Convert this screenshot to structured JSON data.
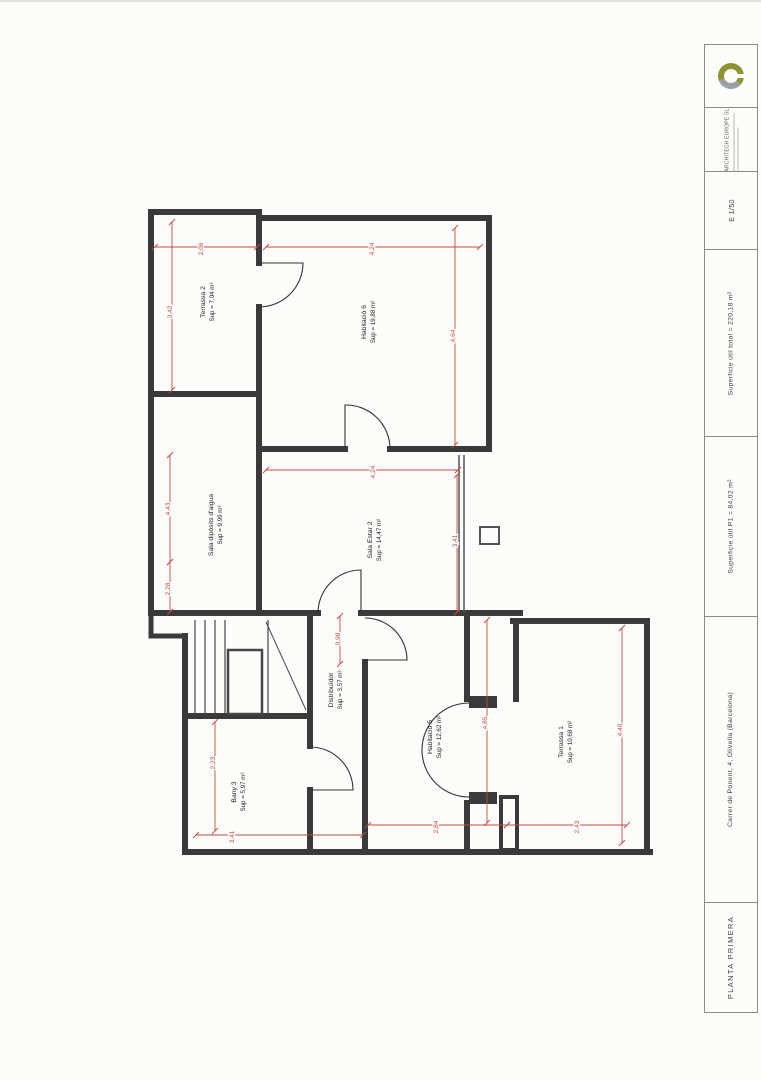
{
  "title_block": {
    "company": "ARCHITECH EUROPE SL",
    "scale": "E  1/50",
    "total_area": "Superficie útil total = 220,18 m²",
    "p1_area": "Superficie útil P1 = 84,02 m²",
    "address": "Carrer de Ponent, 4, Olivella (Barcelona)",
    "plan_name": "PLANTA PRIMERA"
  },
  "colors": {
    "dimension": "#c14a44",
    "wall": "#3a3a3a",
    "text": "#222222",
    "logo_olive": "#8f9433",
    "logo_gray": "#9aa0a6"
  },
  "drawing": {
    "rooms": [
      {
        "id": "terrassa-2",
        "name": "Terrassa 2",
        "area": "Sup = 7,04 m²",
        "x": 205,
        "y": 302
      },
      {
        "id": "habitacio-6",
        "name": "Habitació 6",
        "area": "Sup = 19,88 m²",
        "x": 366,
        "y": 322
      },
      {
        "id": "sala-diposits",
        "name": "Sala dipòsits d'aigua",
        "area": "Sup = 9,99 m²",
        "x": 213,
        "y": 525
      },
      {
        "id": "sala-estar-2",
        "name": "Sala Estar 2",
        "area": "Sup = 14,47 m²",
        "x": 372,
        "y": 540
      },
      {
        "id": "distribuidor",
        "name": "Distribuïdor",
        "area": "Sup = 3,57 m²",
        "x": 333,
        "y": 690
      },
      {
        "id": "habitacio-5",
        "name": "Habitació 5",
        "area": "Sup = 12,62 m²",
        "x": 432,
        "y": 737
      },
      {
        "id": "bany-3",
        "name": "Bany 3",
        "area": "Sup = 5,97 m²",
        "x": 236,
        "y": 792
      },
      {
        "id": "terrassa-1",
        "name": "Terrassa 1",
        "area": "Sup = 10,68 m²",
        "x": 563,
        "y": 742
      }
    ],
    "dimensions": [
      {
        "value": "2,06",
        "x1": 155,
        "y1": 247,
        "x2": 257,
        "y2": 247,
        "lx": 201,
        "ly": 249
      },
      {
        "value": "4,24",
        "x1": 266,
        "y1": 247,
        "x2": 480,
        "y2": 247,
        "lx": 372,
        "ly": 249
      },
      {
        "value": "3,42",
        "x1": 172,
        "y1": 222,
        "x2": 172,
        "y2": 390,
        "lx": 170,
        "ly": 312
      },
      {
        "value": "4,43",
        "x1": 170,
        "y1": 455,
        "x2": 170,
        "y2": 562,
        "lx": 168,
        "ly": 509
      },
      {
        "value": "2,28",
        "x1": 170,
        "y1": 562,
        "x2": 170,
        "y2": 612,
        "lx": 168,
        "ly": 589
      },
      {
        "value": "4,64",
        "x1": 455,
        "y1": 228,
        "x2": 455,
        "y2": 445,
        "lx": 453,
        "ly": 336
      },
      {
        "value": "4,24",
        "x1": 266,
        "y1": 470,
        "x2": 458,
        "y2": 470,
        "lx": 373,
        "ly": 472
      },
      {
        "value": "3,41",
        "x1": 457,
        "y1": 475,
        "x2": 457,
        "y2": 612,
        "lx": 455,
        "ly": 541
      },
      {
        "value": "0,98",
        "x1": 340,
        "y1": 616,
        "x2": 340,
        "y2": 664,
        "lx": 338,
        "ly": 639
      },
      {
        "value": "2,23",
        "x1": 215,
        "y1": 722,
        "x2": 215,
        "y2": 831,
        "lx": 213,
        "ly": 763
      },
      {
        "value": "3,41",
        "x1": 196,
        "y1": 835,
        "x2": 363,
        "y2": 835,
        "lx": 232,
        "ly": 837
      },
      {
        "value": "2,84",
        "x1": 368,
        "y1": 825,
        "x2": 507,
        "y2": 825,
        "lx": 436,
        "ly": 827
      },
      {
        "value": "2,43",
        "x1": 507,
        "y1": 825,
        "x2": 627,
        "y2": 825,
        "lx": 577,
        "ly": 827
      },
      {
        "value": "4,85",
        "x1": 487,
        "y1": 620,
        "x2": 487,
        "y2": 823,
        "lx": 485,
        "ly": 723
      },
      {
        "value": "4,40",
        "x1": 622,
        "y1": 628,
        "x2": 622,
        "y2": 843,
        "lx": 620,
        "ly": 730
      }
    ]
  }
}
